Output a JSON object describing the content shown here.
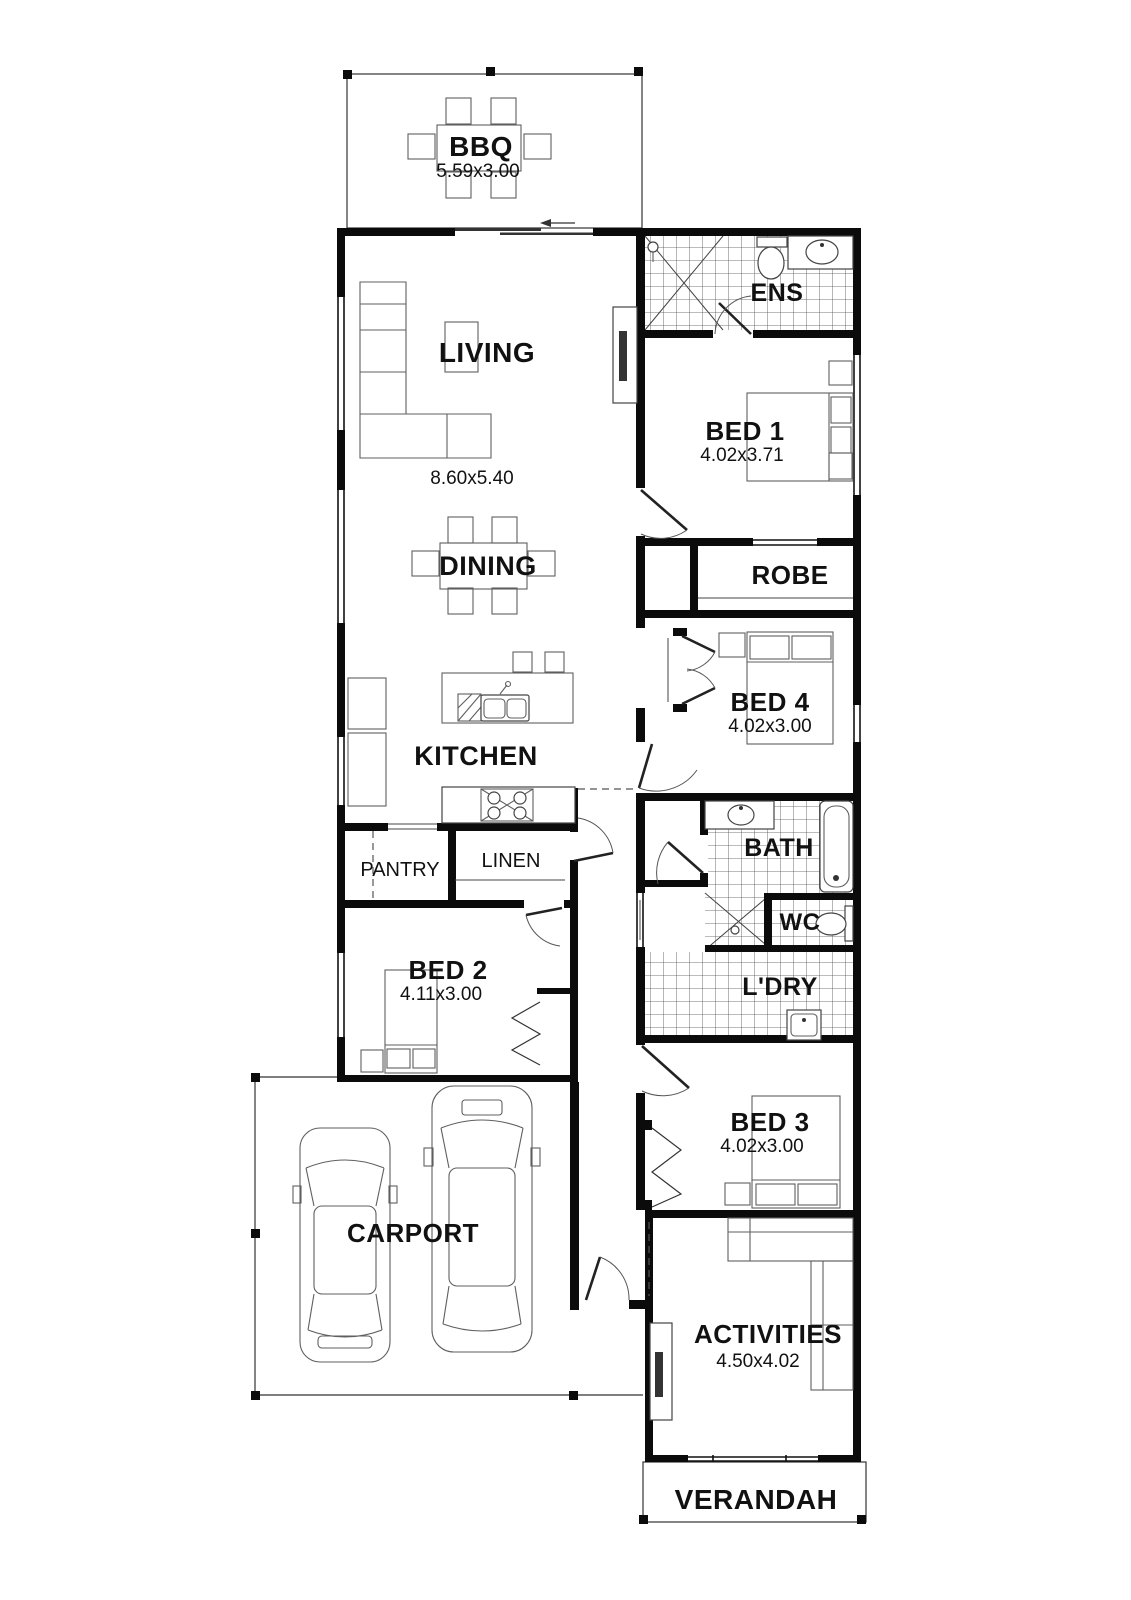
{
  "colors": {
    "wall": "#0b0b0b",
    "line": "#555555",
    "background": "#ffffff"
  },
  "rooms": {
    "bbq": {
      "label": "BBQ",
      "dims": "5.59x3.00"
    },
    "living": {
      "label": "LIVING",
      "dims": "8.60x5.40"
    },
    "dining": {
      "label": "DINING"
    },
    "kitchen": {
      "label": "KITCHEN"
    },
    "ens": {
      "label": "ENS"
    },
    "bed1": {
      "label": "BED 1",
      "dims": "4.02x3.71"
    },
    "robe": {
      "label": "ROBE"
    },
    "bed4": {
      "label": "BED 4",
      "dims": "4.02x3.00"
    },
    "pantry": {
      "label": "PANTRY"
    },
    "linen": {
      "label": "LINEN"
    },
    "bath": {
      "label": "BATH"
    },
    "wc": {
      "label": "WC"
    },
    "laundry": {
      "label": "L'DRY"
    },
    "bed2": {
      "label": "BED 2",
      "dims": "4.11x3.00"
    },
    "bed3": {
      "label": "BED 3",
      "dims": "4.02x3.00"
    },
    "carport": {
      "label": "CARPORT"
    },
    "activities": {
      "label": "ACTIVITIES",
      "dims": "4.50x4.02"
    },
    "verandah": {
      "label": "VERANDAH"
    }
  }
}
